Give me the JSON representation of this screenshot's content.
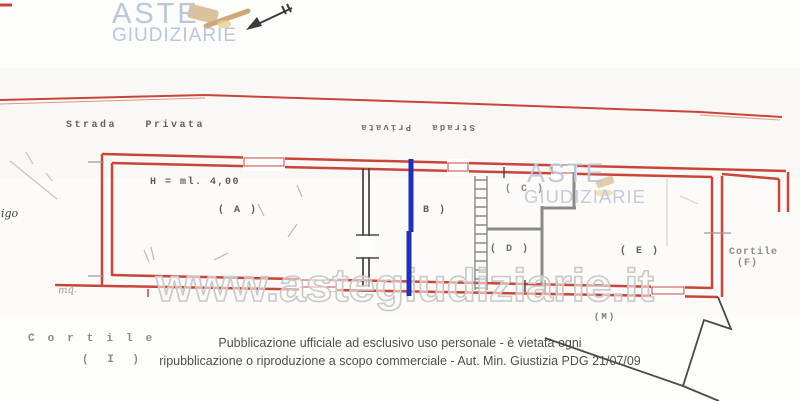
{
  "colors": {
    "plan_red": "#c9453a",
    "marker_blue": "#2130b4",
    "wall_dark": "#4a4a4a",
    "wall_gray": "#8a8a8a",
    "logo_blue": "#b9c6db",
    "gavel_tan": "#dcc29c",
    "gavel_gold": "#e5cf8e",
    "watermark_stroke": "#c9c9c9",
    "label_gray": "#6b6b6b",
    "footer_gray": "#4f4f4f",
    "pencil_gray": "#c6c6c6"
  },
  "logo": {
    "line1": "ASTE",
    "line2": "GIUDIZIARIE"
  },
  "plan_watermark": {
    "line1": "ASTE",
    "line2": "GIUDIZIARIE"
  },
  "watermark": {
    "text": "www.astegiudiziarie.it"
  },
  "labels": {
    "street": "Strada Privata",
    "street_rotated": "Strada Privata",
    "height_note": "H = ml. 4,00",
    "room_a": "( A )",
    "room_b": "B )",
    "room_c": "( C )",
    "room_d": "( D )",
    "room_e": "( E )",
    "room_m": "(M)",
    "cortile_right_name": "Cortile",
    "cortile_right_id": "(F)",
    "cortile_left_name": "Cortile",
    "cortile_left_id": "( I )",
    "left_edge_note": "igo",
    "area_note": "mq."
  },
  "footer": {
    "line1": "Pubblicazione ufficiale ad esclusivo uso personale - è vietata ogni",
    "line2": "ripubblicazione o riproduzione a scopo commerciale - Aut. Min. Giustizia PDG 21/07/09"
  }
}
